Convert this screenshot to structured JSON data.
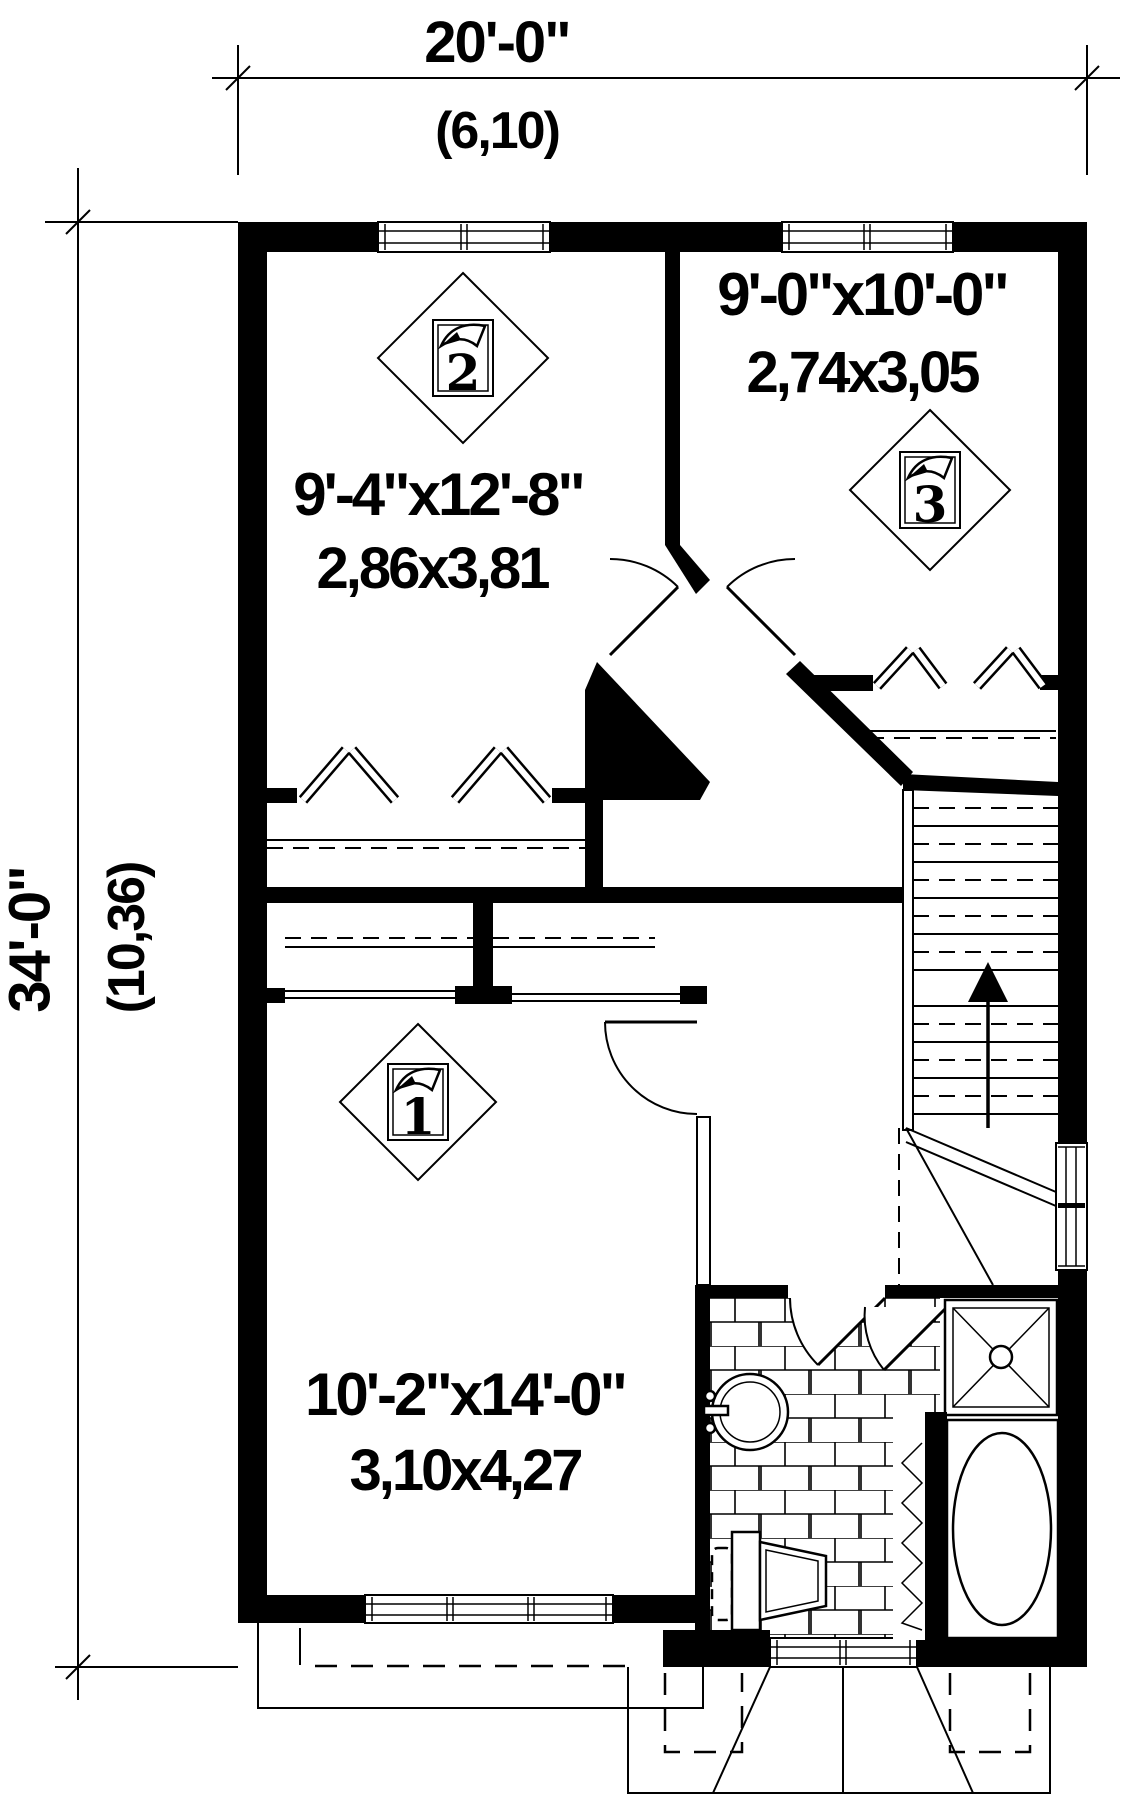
{
  "title": "Second floor plan",
  "colors": {
    "ink": "#000000",
    "paper": "#ffffff"
  },
  "dimensions": {
    "top": {
      "imperial": "20'-0\"",
      "metric": "(6,10)"
    },
    "left": {
      "imperial": "34'-0\"",
      "metric": "(10,36)"
    }
  },
  "rooms": {
    "bedroom2": {
      "marker": "2",
      "imperial": "9'-4\"x12'-8\"",
      "metric": "2,86x3,81"
    },
    "bedroom3": {
      "marker": "3",
      "imperial": "9'-0\"x10'-0\"",
      "metric": "2,74x3,05"
    },
    "bedroom1": {
      "marker": "1",
      "imperial": "10'-2\"x14'-0\"",
      "metric": "3,10x4,27"
    }
  },
  "icons": {
    "stairs_arrow": "up-direction-arrow",
    "sink": "round-lavatory",
    "toilet": "toilet",
    "shower": "corner-shower",
    "bathtub": "oval-bathtub"
  }
}
